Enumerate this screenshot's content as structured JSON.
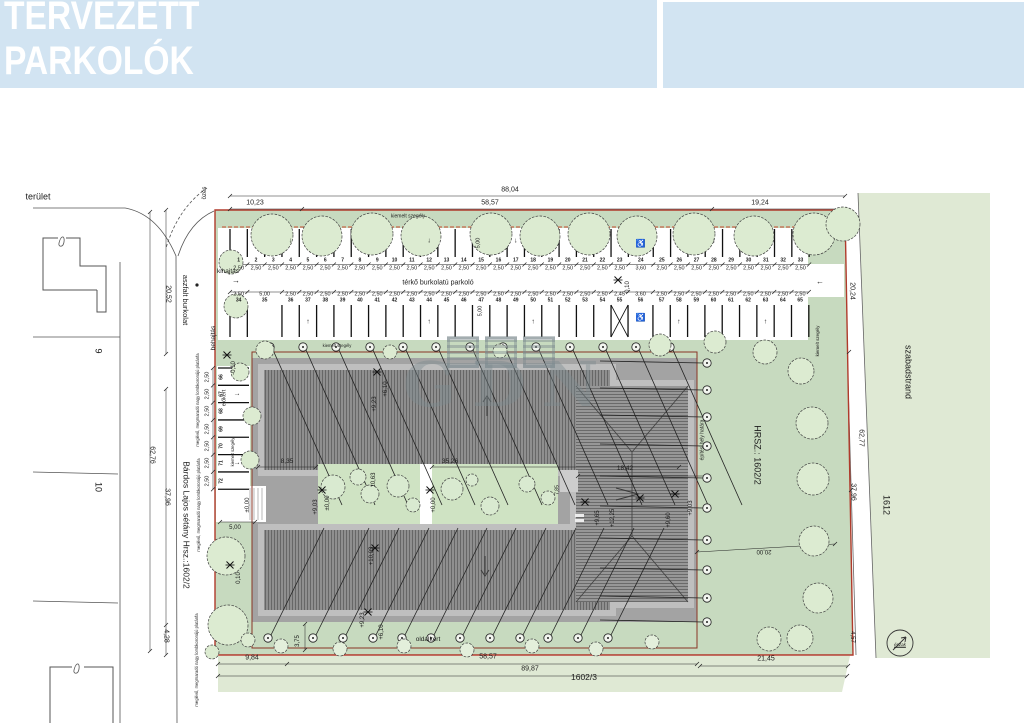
{
  "header": {
    "line1": "TERVEZETT",
    "line2": "PARKOLÓK"
  },
  "watermark": {
    "text": "GDN"
  },
  "colors": {
    "header_bg": "#d2e4f2",
    "green_main": "#c7dabf",
    "green_light": "#dfe9d4",
    "green_court": "#cfe3c3",
    "building_gray": "#a3a3a3",
    "roof_gray": "#8f8f8f",
    "boundary_red": "#b03a2b"
  },
  "labels": {
    "terulet": "terület",
    "ozes": "özés",
    "kihajtas": "kihajtás",
    "behajtas": "behajtás",
    "terko": "térkő burkolatú parkoló",
    "kiemelt": "kiemelt szegély",
    "elokert": "előkert",
    "oldalkert": "oldalkert",
    "aszfalt": "aszfalt burkolat",
    "bardos": "Bárdos Lajos sétány Hrsz.:1602/2",
    "szabadstrand": "szabadstrand",
    "hrsz": "HRSZ.: 1602/2",
    "parcel_1612": "1612",
    "parcel_1602_3": "1602/3",
    "parcel_9": "9",
    "parcel_10": "10",
    "eszak": "észak",
    "epitesi": "építési hely határa",
    "platan": "meglévő, megmaradó nagy lombkoronájú platánfa"
  },
  "dims": {
    "d8804": "88,04",
    "d1023": "10,23",
    "d5857": "58,57",
    "d1924": "19,24",
    "d2052": "20,52",
    "d6276": "62,76",
    "d3796": "37,96",
    "d428": "4,28",
    "d2024": "20,24",
    "d6277": "62,77",
    "d3796r": "37,96",
    "d984": "9,84",
    "d5857b": "58,57",
    "d8987": "89,87",
    "d2145": "21,45",
    "d457": "4,57",
    "d2000": "20,00",
    "d375": "3,75",
    "d835": "8,35",
    "d3526": "35,26",
    "d1842": "18,42",
    "d1063": "10,63",
    "d785": "7,85",
    "d500": "5,00"
  },
  "elevations": {
    "e610": "+6,10",
    "e923": "+9,23",
    "e000": "±0,00",
    "p000": "+0,00",
    "e903": "+9,03",
    "e903b": "+9,03",
    "e1003": "+10,03",
    "e1225": "+12,25",
    "e960": "+9,60",
    "e965": "+9,65",
    "m010": "-0,10",
    "z010": "0,10"
  },
  "parking": {
    "row1_numbers": [
      "1",
      "2",
      "3",
      "4",
      "5",
      "6",
      "7",
      "8",
      "9",
      "10",
      "11",
      "12",
      "13",
      "14",
      "15",
      "16",
      "17",
      "18",
      "19",
      "20",
      "21",
      "22",
      "23",
      "24",
      "25",
      "26",
      "27",
      "28",
      "29",
      "30",
      "31",
      "32",
      "33"
    ],
    "row1_dims": [
      "2,50",
      "2,50",
      "2,50",
      "2,50",
      "2,50",
      "2,50",
      "2,50",
      "2,50",
      "2,50",
      "2,50",
      "2,50",
      "2,50",
      "2,50",
      "2,50",
      "2,50",
      "2,50",
      "2,50",
      "2,50",
      "2,50",
      "2,50",
      "2,50",
      "2,50",
      "2,50",
      "3,60",
      "2,50",
      "2,50",
      "2,50",
      "2,50",
      "2,50",
      "2,50",
      "2,50",
      "2,50",
      "2,50"
    ],
    "row2_numbers": [
      "34",
      "35",
      "36",
      "37",
      "38",
      "39",
      "40",
      "41",
      "42",
      "43",
      "44",
      "45",
      "46",
      "47",
      "48",
      "49",
      "50",
      "51",
      "52",
      "53",
      "54",
      "55",
      "56",
      "57",
      "58",
      "59",
      "60",
      "61",
      "62",
      "63",
      "64",
      "65"
    ],
    "row2_dims": [
      "2,50",
      "5,00",
      "2,50",
      "2,50",
      "2,50",
      "2,50",
      "2,50",
      "2,50",
      "2,50",
      "2,50",
      "2,50",
      "2,50",
      "2,50",
      "2,50",
      "2,50",
      "2,50",
      "2,50",
      "2,50",
      "2,50",
      "2,50",
      "2,50",
      "2,45",
      "3,60",
      "2,50",
      "2,50",
      "2,50",
      "2,50",
      "2,50",
      "2,50",
      "2,50",
      "2,50",
      "2,50"
    ],
    "left_numbers": [
      "66",
      "67",
      "68",
      "69",
      "70",
      "71",
      "72"
    ],
    "left_dims": [
      "2,50",
      "2,50",
      "2,50",
      "2,50",
      "2,50",
      "2,50",
      "2,50"
    ],
    "accessible_icon": "♿",
    "arrow_down": "↓",
    "arrow_up": "↑",
    "arrow_right": "→",
    "arrow_left": "←"
  }
}
